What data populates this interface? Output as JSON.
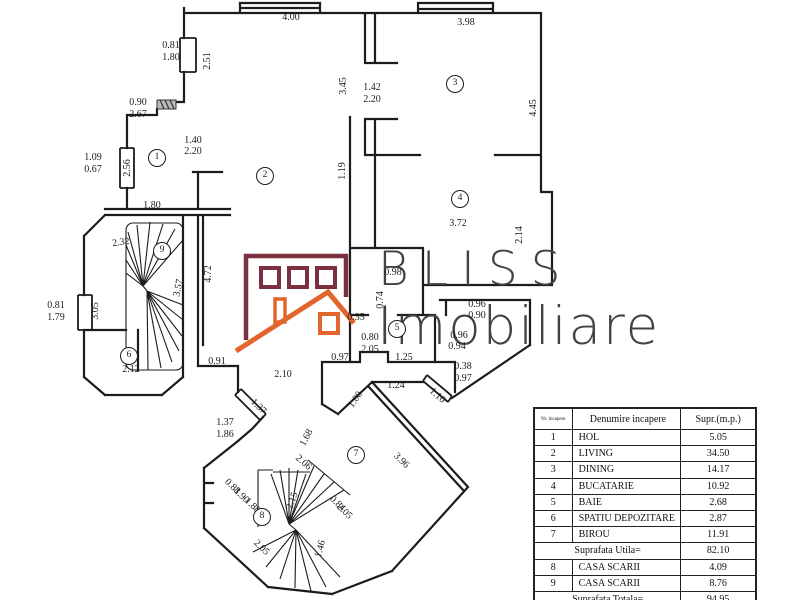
{
  "watermark": {
    "line1": "BLISS",
    "line2": "Imobiliare",
    "wall_color": "#7b3040",
    "roof_color": "#e2662c",
    "text_color": "#424242"
  },
  "table": {
    "headers": {
      "nr": "Nr. incapere",
      "name": "Denumire  incapere",
      "area": "Supr.(m.p.)"
    },
    "rows": [
      {
        "nr": "1",
        "name": "HOL",
        "area": "5.05",
        "summary": false
      },
      {
        "nr": "2",
        "name": "LIVING",
        "area": "34.50",
        "summary": false
      },
      {
        "nr": "3",
        "name": "DINING",
        "area": "14.17",
        "summary": false
      },
      {
        "nr": "4",
        "name": "BUCATARIE",
        "area": "10.92",
        "summary": false
      },
      {
        "nr": "5",
        "name": "BAIE",
        "area": "2.68",
        "summary": false
      },
      {
        "nr": "6",
        "name": "SPATIU DEPOZITARE",
        "area": "2.87",
        "summary": false
      },
      {
        "nr": "7",
        "name": "BIROU",
        "area": "11.91",
        "summary": false
      },
      {
        "nr": "",
        "name": "Suprafata Utila=",
        "area": "82.10",
        "summary": true
      },
      {
        "nr": "8",
        "name": "CASA SCARII",
        "area": "4.09",
        "summary": false
      },
      {
        "nr": "9",
        "name": "CASA SCARII",
        "area": "8.76",
        "summary": false
      },
      {
        "nr": "",
        "name": "Suprafata Totala=",
        "area": "94.95",
        "summary": true
      }
    ]
  },
  "rooms": [
    {
      "n": "1",
      "x": 157,
      "y": 158
    },
    {
      "n": "2",
      "x": 265,
      "y": 176
    },
    {
      "n": "3",
      "x": 455,
      "y": 84
    },
    {
      "n": "4",
      "x": 460,
      "y": 199
    },
    {
      "n": "5",
      "x": 397,
      "y": 329
    },
    {
      "n": "6",
      "x": 129,
      "y": 356
    },
    {
      "n": "7",
      "x": 356,
      "y": 455
    },
    {
      "n": "8",
      "x": 262,
      "y": 517
    },
    {
      "n": "9",
      "x": 162,
      "y": 251
    }
  ],
  "dimensions": [
    {
      "t": "4.00",
      "x": 291,
      "y": 18,
      "r": 0
    },
    {
      "t": "0.81",
      "x": 171,
      "y": 46,
      "r": 0
    },
    {
      "t": "1.80",
      "x": 171,
      "y": 58,
      "r": 0
    },
    {
      "t": "2.51",
      "x": 208,
      "y": 61,
      "r": -90
    },
    {
      "t": "3.98",
      "x": 466,
      "y": 23,
      "r": 0
    },
    {
      "t": "3.45",
      "x": 344,
      "y": 86,
      "r": -90
    },
    {
      "t": "1.42",
      "x": 372,
      "y": 88,
      "r": 0
    },
    {
      "t": "2.20",
      "x": 372,
      "y": 100,
      "r": 0
    },
    {
      "t": "4.45",
      "x": 534,
      "y": 108,
      "r": -90
    },
    {
      "t": "0.90",
      "x": 138,
      "y": 103,
      "r": 0
    },
    {
      "t": "2.67",
      "x": 138,
      "y": 115,
      "r": 0
    },
    {
      "t": "1.40",
      "x": 193,
      "y": 141,
      "r": 0
    },
    {
      "t": "2.20",
      "x": 193,
      "y": 152,
      "r": 0
    },
    {
      "t": "1.09",
      "x": 93,
      "y": 158,
      "r": 0
    },
    {
      "t": "0.67",
      "x": 93,
      "y": 170,
      "r": 0
    },
    {
      "t": "2.56",
      "x": 128,
      "y": 168,
      "r": -90
    },
    {
      "t": "1.19",
      "x": 343,
      "y": 171,
      "r": -90
    },
    {
      "t": "1.80",
      "x": 152,
      "y": 206,
      "r": 0
    },
    {
      "t": "3.72",
      "x": 458,
      "y": 224,
      "r": 0
    },
    {
      "t": "2.14",
      "x": 520,
      "y": 235,
      "r": -90
    },
    {
      "t": "2.32",
      "x": 121,
      "y": 243,
      "r": -8
    },
    {
      "t": "4.72",
      "x": 209,
      "y": 274,
      "r": -90
    },
    {
      "t": "3.57",
      "x": 179,
      "y": 288,
      "r": -78
    },
    {
      "t": "0.81",
      "x": 56,
      "y": 306,
      "r": 0
    },
    {
      "t": "1.79",
      "x": 56,
      "y": 318,
      "r": 0
    },
    {
      "t": "3.05",
      "x": 96,
      "y": 311,
      "r": -90
    },
    {
      "t": "2.12",
      "x": 131,
      "y": 370,
      "r": 0
    },
    {
      "t": "0.91",
      "x": 217,
      "y": 362,
      "r": 0
    },
    {
      "t": "2.10",
      "x": 283,
      "y": 375,
      "r": 0
    },
    {
      "t": "0.98",
      "x": 393,
      "y": 273,
      "r": 0
    },
    {
      "t": "0.74",
      "x": 381,
      "y": 300,
      "r": -90
    },
    {
      "t": "0.35",
      "x": 356,
      "y": 318,
      "r": 0
    },
    {
      "t": "0.96",
      "x": 477,
      "y": 305,
      "r": 0
    },
    {
      "t": "0.90",
      "x": 477,
      "y": 316,
      "r": 0
    },
    {
      "t": "0.96",
      "x": 459,
      "y": 336,
      "r": 0
    },
    {
      "t": "0.94",
      "x": 457,
      "y": 347,
      "r": 0
    },
    {
      "t": "0.80",
      "x": 370,
      "y": 338,
      "r": 0
    },
    {
      "t": "2.05",
      "x": 370,
      "y": 350,
      "r": 0
    },
    {
      "t": "0.97",
      "x": 340,
      "y": 358,
      "r": 0
    },
    {
      "t": "1.25",
      "x": 404,
      "y": 358,
      "r": 0
    },
    {
      "t": "0.38",
      "x": 463,
      "y": 367,
      "r": 0
    },
    {
      "t": "0.97",
      "x": 463,
      "y": 379,
      "r": 0
    },
    {
      "t": "1.24",
      "x": 396,
      "y": 386,
      "r": 0
    },
    {
      "t": "1.00",
      "x": 356,
      "y": 400,
      "r": -55
    },
    {
      "t": "1.10",
      "x": 437,
      "y": 396,
      "r": 42
    },
    {
      "t": "1.37",
      "x": 258,
      "y": 407,
      "r": 44
    },
    {
      "t": "1.37",
      "x": 225,
      "y": 423,
      "r": 0
    },
    {
      "t": "1.86",
      "x": 225,
      "y": 435,
      "r": 0
    },
    {
      "t": "1.68",
      "x": 307,
      "y": 438,
      "r": -62
    },
    {
      "t": "2.06",
      "x": 303,
      "y": 463,
      "r": 42
    },
    {
      "t": "3.96",
      "x": 401,
      "y": 461,
      "r": 44
    },
    {
      "t": "0.88",
      "x": 232,
      "y": 487,
      "r": 44
    },
    {
      "t": "1.90",
      "x": 241,
      "y": 496,
      "r": 44
    },
    {
      "t": "1.88",
      "x": 252,
      "y": 506,
      "r": 44
    },
    {
      "t": "2.15",
      "x": 293,
      "y": 501,
      "r": -70
    },
    {
      "t": "0.84",
      "x": 337,
      "y": 504,
      "r": 44
    },
    {
      "t": "2.05",
      "x": 344,
      "y": 512,
      "r": 44
    },
    {
      "t": "2.05",
      "x": 261,
      "y": 548,
      "r": 44
    },
    {
      "t": "1.46",
      "x": 321,
      "y": 549,
      "r": -75
    }
  ]
}
